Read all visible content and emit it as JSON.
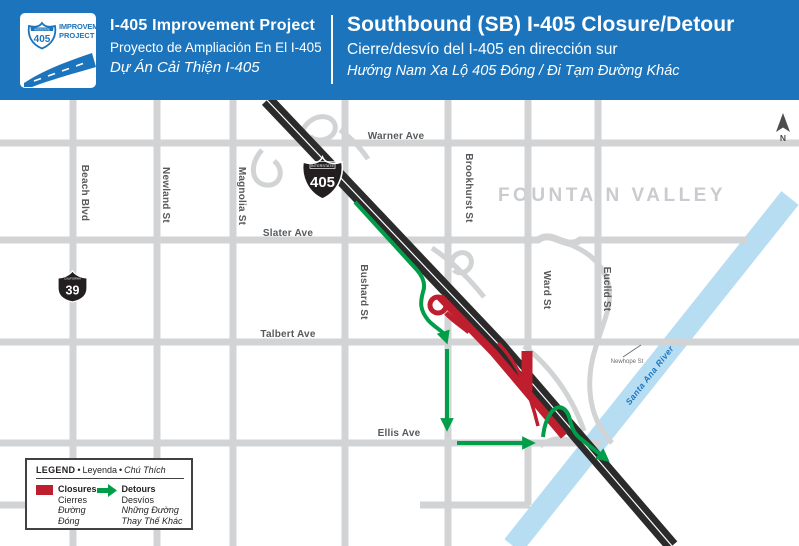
{
  "header": {
    "logo": {
      "interstate": "INTERSTATE",
      "shield_number": "405",
      "line1": "IMPROVEMENT",
      "line2": "PROJECT"
    },
    "left": {
      "title": "I-405 Improvement Project",
      "subtitle_es": "Proyecto de Ampliación En El I-405",
      "subtitle_vi": "Dự Án Cải Thiện I-405"
    },
    "right": {
      "title": "Southbound (SB) I-405 Closure/Detour",
      "subtitle_es": "Cierre/desvío del I-405 en dirección sur",
      "subtitle_vi": "Hướng Nam Xa Lộ 405 Đóng / Đi Tạm Đường Khác"
    }
  },
  "map": {
    "city_label": "FOUNTAIN VALLEY",
    "north_label": "N",
    "river_label": "Santa Ana River",
    "freeway_shield": {
      "top": "INTERSTATE",
      "number": "405"
    },
    "route_shield": {
      "top": "CALIFORNIA",
      "number": "39"
    },
    "streets": {
      "warner": "Warner Ave",
      "slater": "Slater Ave",
      "talbert": "Talbert Ave",
      "ellis": "Ellis Ave",
      "beach": "Beach Blvd",
      "newland": "Newland St",
      "magnolia": "Magnolia St",
      "bushard": "Bushard St",
      "brookhurst": "Brookhurst St",
      "ward": "Ward St",
      "euclid": "Euclid St",
      "newhope": "Newhope St"
    }
  },
  "legend": {
    "title_en": "LEGEND",
    "title_es": "Leyenda",
    "title_vi": "Chú Thích",
    "separator": "•",
    "closures": {
      "en": "Closures",
      "es": "Cierres",
      "vi": "Đường Đóng"
    },
    "detours": {
      "en": "Detours",
      "es": "Desvíos",
      "vi": "Những Đường Thay Thế Khác"
    }
  },
  "colors": {
    "header_blue": "#1c75bc",
    "closure_red": "#be1e2d",
    "detour_green": "#009e49",
    "river_blue": "#b7ddf3",
    "street_gray": "#d1d3d4",
    "freeway_dark": "#2b2b2b",
    "label_gray": "#58595b"
  }
}
